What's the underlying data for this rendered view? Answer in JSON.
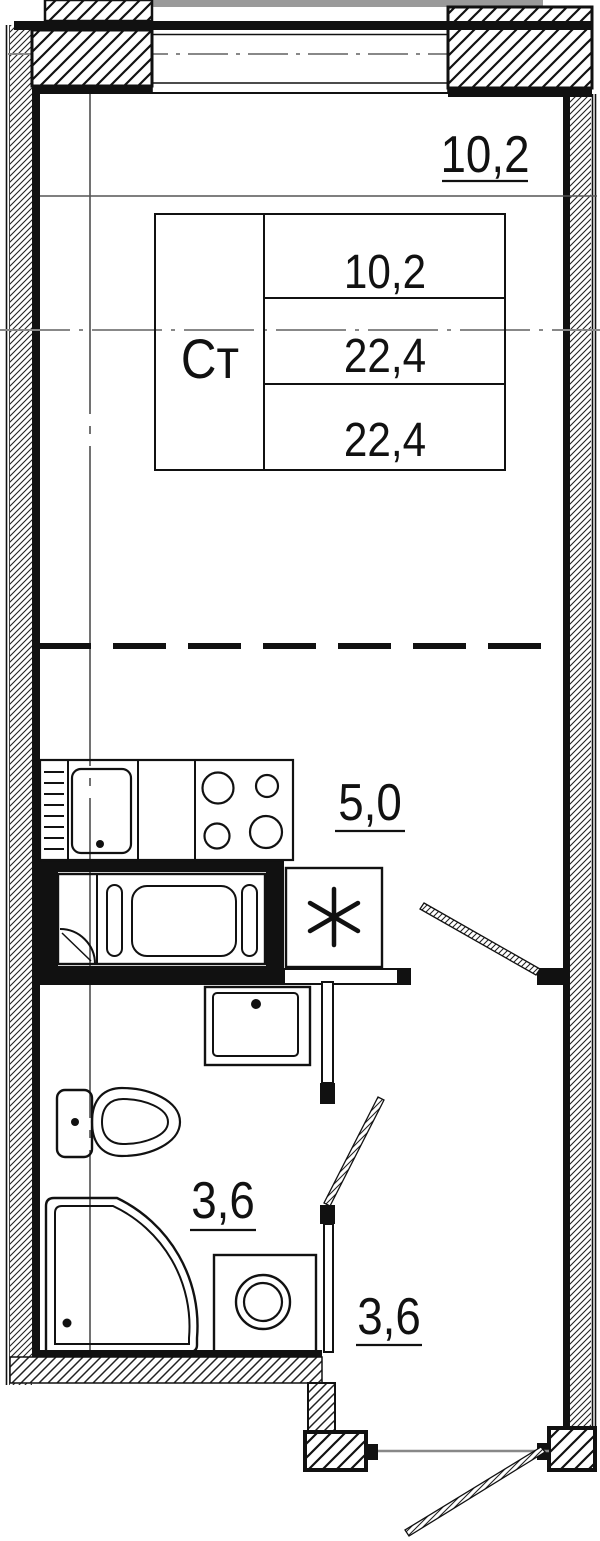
{
  "plan": {
    "unit_table": {
      "type": "Ст",
      "values": [
        "10,2",
        "22,4",
        "22,4"
      ]
    },
    "rooms": {
      "living": {
        "name": "living-room",
        "area": "10,2"
      },
      "kitchen": {
        "name": "kitchen-zone",
        "area": "5,0"
      },
      "bathroom": {
        "name": "bathroom",
        "area": "3,6"
      },
      "hallway": {
        "name": "hallway",
        "area": "3,6"
      }
    },
    "fixtures": [
      "dish-rack",
      "kitchen-sink",
      "stove-4-burners",
      "refrigerator-snowflake",
      "bathtub",
      "wash-basin",
      "toilet",
      "shower-tray",
      "washing-machine"
    ],
    "doors": [
      "interior-door",
      "bathroom-door",
      "entrance-door"
    ],
    "colors": {
      "line": "#111111",
      "axis_grey": "#888888",
      "slab_grey": "#9a9a9a",
      "background": "#ffffff"
    }
  }
}
